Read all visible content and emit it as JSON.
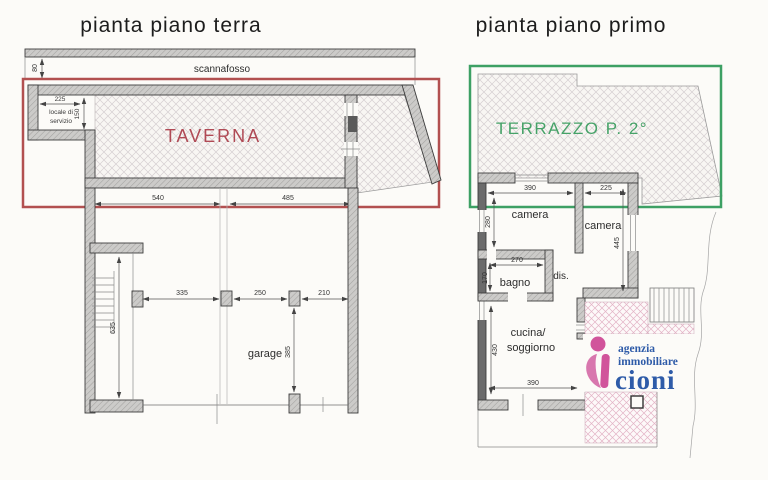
{
  "document": {
    "type": "real-estate floor plan scan",
    "colors": {
      "red_box": "#b25050",
      "green_box": "#3da064",
      "taverna_text": "#b04a55",
      "terrazzo_text": "#46a268",
      "logo_pink": "#d1549b",
      "logo_blue": "#2e5ba8"
    }
  },
  "left_plan": {
    "title": "pianta piano terra",
    "labels": {
      "scannafosso": "scannafosso",
      "locale_line1": "locale di",
      "locale_line2": "servizio",
      "taverna": "TAVERNA",
      "garage": "garage"
    },
    "dims": {
      "scannafosso_depth": "80",
      "locale_w": "225",
      "locale_h": "150",
      "tav_w1": "540",
      "tav_w2": "485",
      "stair_h": "635",
      "g1": "335",
      "g2": "250",
      "g3": "210",
      "g4": "385"
    }
  },
  "right_plan": {
    "title": "pianta piano primo",
    "labels": {
      "terrazzo": "TERRAZZO P. 2°",
      "camera_left": "camera",
      "camera_right": "camera",
      "bagno": "bagno",
      "dis": "dis.",
      "cucina_line1": "cucina/",
      "cucina_line2": "soggiorno"
    },
    "dims": {
      "cam_l_w": "390",
      "cam_r_w": "225",
      "cam_l_h": "280",
      "cam_r_h": "445",
      "bagno_w": "270",
      "bagno_h": "170",
      "cucina_h": "430",
      "cucina_w": "390"
    }
  },
  "logo": {
    "line1": "agenzia",
    "line2": "immobiliare",
    "line3": "cioni"
  }
}
